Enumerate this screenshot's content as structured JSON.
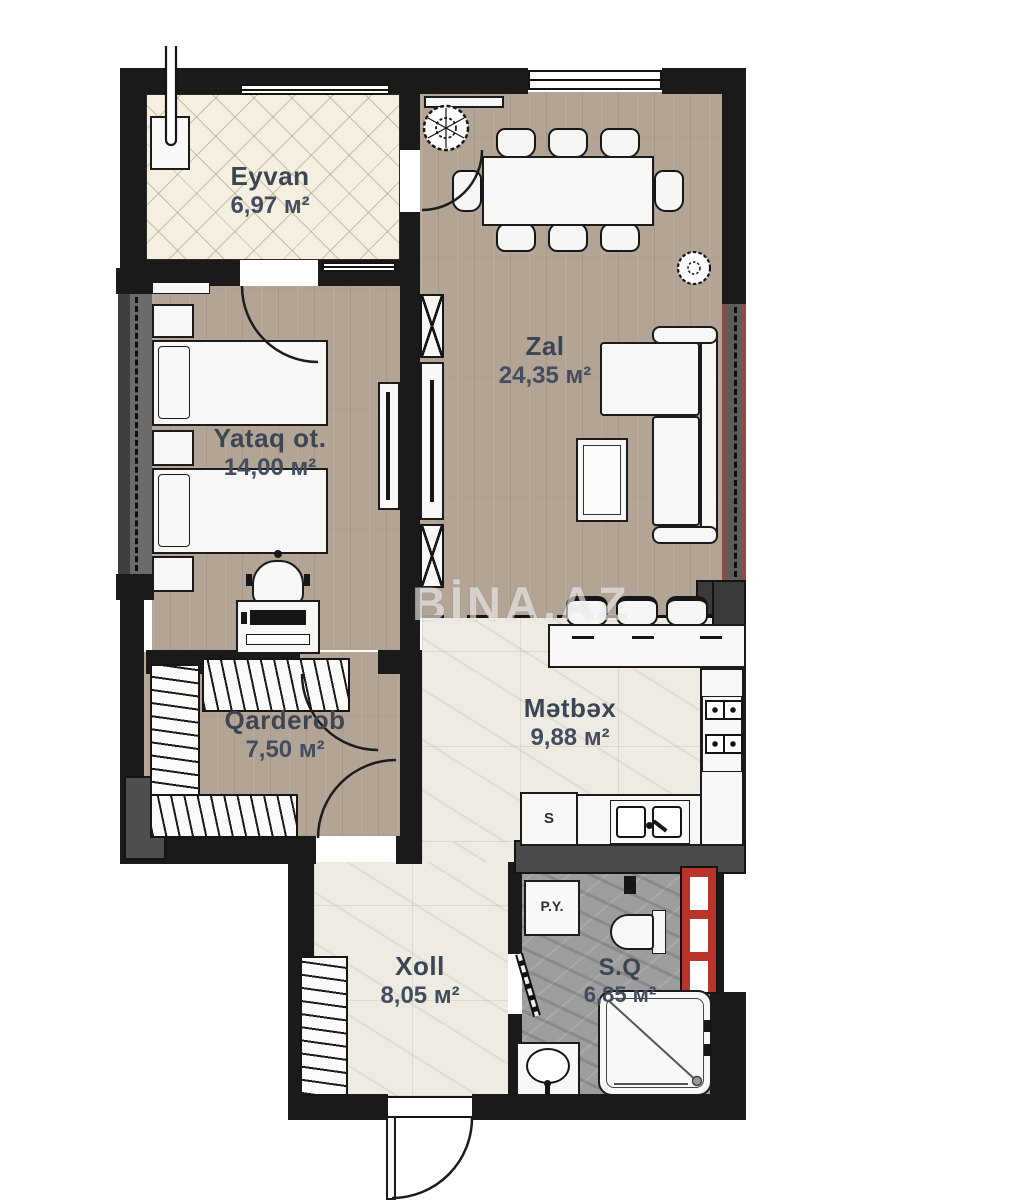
{
  "watermark": "BİNA.AZ",
  "rooms": {
    "eyvan": {
      "name": "Eyvan",
      "area": "6,97 м²"
    },
    "zal": {
      "name": "Zal",
      "area": "24,35 м²"
    },
    "yataq": {
      "name": "Yataq ot.",
      "area": "14,00 м²"
    },
    "qarderob": {
      "name": "Qarderob",
      "area": "7,50 м²"
    },
    "metbex": {
      "name": "Mətbəx",
      "area": "9,88 м²"
    },
    "xoll": {
      "name": "Xoll",
      "area": "8,05 м²"
    },
    "sq": {
      "name": "S.Q",
      "area": "6,85 м²"
    }
  },
  "appliance_labels": {
    "washing_machine": "P.Y.",
    "fridge": "S"
  },
  "colors": {
    "wall": "#1a1a1a",
    "towel_rail_red": "#b9352b",
    "window_frame_red": "#8e4b42",
    "label_text": "#3d4553",
    "wood_floor": "#b3a596",
    "balcony_tile": "#f4efe1",
    "marble_floor": "#edebe2",
    "bathroom_stone": "#9d9d9d"
  }
}
